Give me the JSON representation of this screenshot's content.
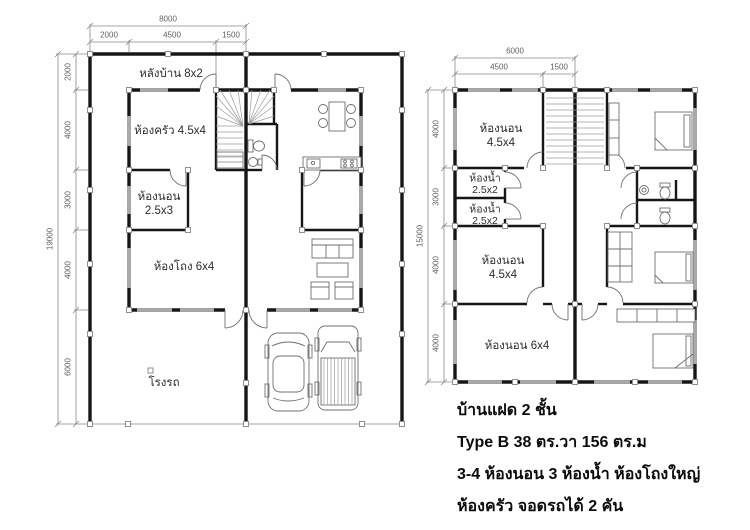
{
  "ground_floor": {
    "dim_total_width": "8000",
    "dim_width_segments": [
      "2000",
      "4500",
      "1500"
    ],
    "dim_total_height": "19000",
    "dim_height_segments": [
      "2000",
      "4000",
      "3000",
      "4000",
      "6000"
    ],
    "rooms": {
      "back_yard": "หลังบ้าน 8x2",
      "kitchen": "ห้องครัว 4.5x4",
      "bedroom_l1": "ห้องนอน",
      "bedroom_l2": "2.5x3",
      "hall": "ห้องโถง 6x4",
      "garage": "โรงรถ"
    }
  },
  "second_floor": {
    "dim_total_width": "6000",
    "dim_width_segments": [
      "4500",
      "1500"
    ],
    "dim_total_height": "15000",
    "dim_height_segments": [
      "4000",
      "3000",
      "4000",
      "4000"
    ],
    "rooms": {
      "bedroom_top_l1": "ห้องนอน",
      "bedroom_top_l2": "4.5x4",
      "bath1_l1": "ห้องน้ำ",
      "bath1_l2": "2.5x2",
      "bath2_l1": "ห้องน้ำ",
      "bath2_l2": "2.5x2",
      "bedroom_mid_l1": "ห้องนอน",
      "bedroom_mid_l2": "4.5x4",
      "bedroom_bottom": "ห้องนอน 6x4"
    }
  },
  "caption": {
    "line1": "บ้านแฝด 2 ชั้น",
    "line2": "Type B 38 ตร.วา 156 ตร.ม",
    "line3": "3-4 ห้องนอน 3 ห้องน้ำ ห้องโถงใหญ่",
    "line4": "ห้องครัว จอดรถได้ 2 คัน"
  },
  "colors": {
    "wall": "#161616",
    "window": "#aaaaaa",
    "dimension": "#8a8a8a",
    "label_text": "#2d2d2d",
    "caption_text": "#0b0b0b"
  }
}
